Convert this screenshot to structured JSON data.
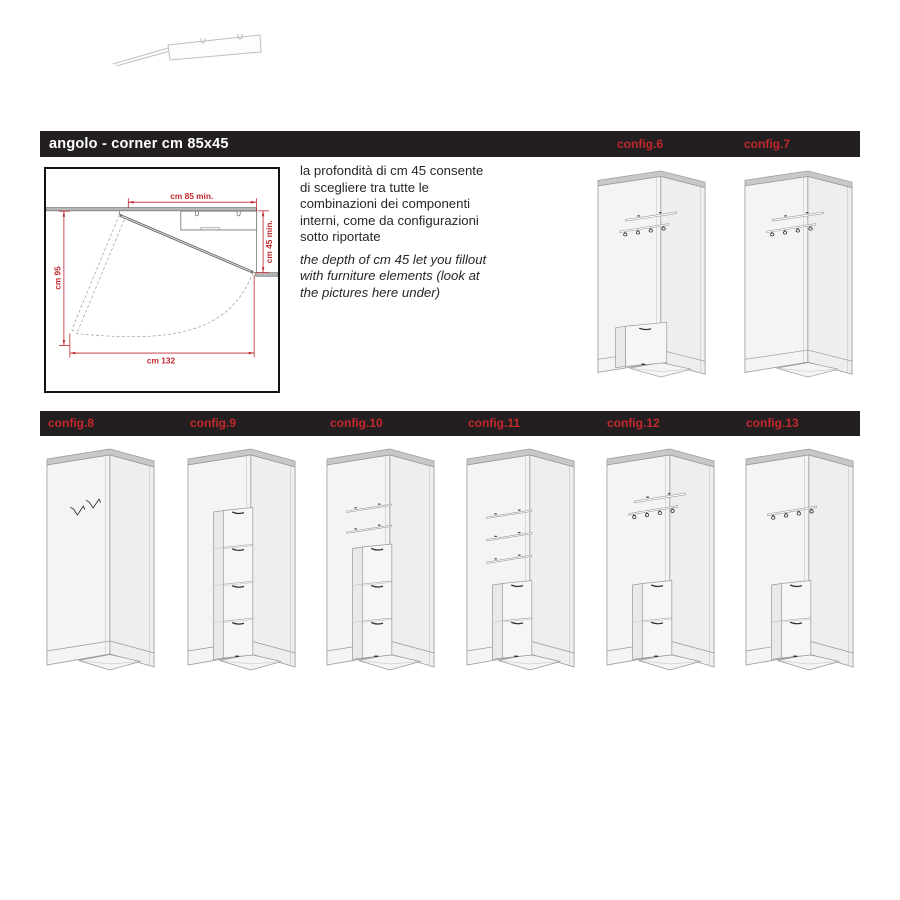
{
  "colors": {
    "bar_bg": "#231f20",
    "accent_red": "#c1272d",
    "text_dark": "#2a2627",
    "wall_gray": "#b5b6b8",
    "wall_edge": "#6a6c6e",
    "cap_gray": "#c8c8c7",
    "face_light": "#f4f4f2",
    "face_side": "#eeeeec",
    "face_drawer": "#f6f6f4",
    "face_drawer_side": "#e9e9e7",
    "line_gray": "#96989a",
    "line_soft": "#bcbebd",
    "detail_dark": "#333333",
    "dash_gray": "#9a9ca0"
  },
  "header_bar": {
    "title": "angolo - corner cm 85x45"
  },
  "intro": {
    "italian": "la profondità di cm 45 consente di scegliere tra tutte le combinazioni dei componenti interni, come da configurazioni sotto riportate",
    "english": "the depth of cm 45 let you fillout with furniture elements (look at the pictures here under)"
  },
  "diagram": {
    "dim_top": "cm 85 min.",
    "dim_right": "cm 45 min.",
    "dim_left": "cm 95",
    "dim_bottom": "cm 132"
  },
  "top_row": [
    {
      "label": "config.6",
      "features": {
        "shelf": true,
        "hook_rail": true,
        "base_cabinet": true
      }
    },
    {
      "label": "config.7",
      "features": {
        "shelf": true,
        "hook_rail": true
      }
    }
  ],
  "bottom_row": [
    {
      "label": "config.8",
      "features": {
        "wall_hooks": 2
      }
    },
    {
      "label": "config.9",
      "features": {
        "drawer_units": 4
      }
    },
    {
      "label": "config.10",
      "features": {
        "shelves": 2,
        "drawer_units": 3
      }
    },
    {
      "label": "config.11",
      "features": {
        "shelves": 3,
        "drawer_units": 2
      }
    },
    {
      "label": "config.12",
      "features": {
        "shelf": true,
        "hook_rail": true,
        "drawer_units": 2
      }
    },
    {
      "label": "config.13",
      "features": {
        "hook_rail": true,
        "drawer_units": 2
      }
    }
  ]
}
